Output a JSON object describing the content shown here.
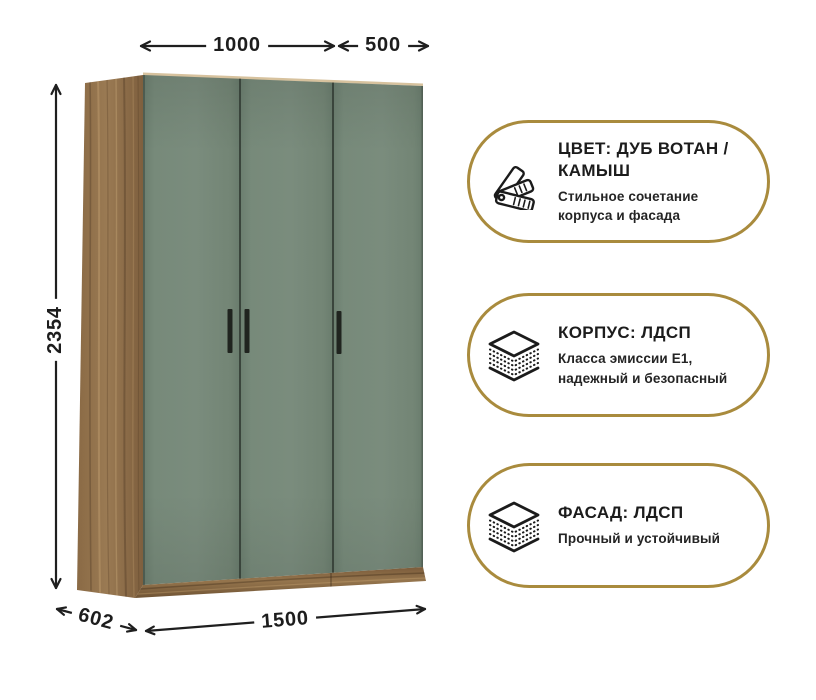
{
  "dimensions": {
    "door_pair_width": "1000",
    "door_single_width": "500",
    "height": "2354",
    "depth": "602",
    "total_width": "1500"
  },
  "badges": [
    {
      "icon": "color-swatches-icon",
      "title": "ЦВЕТ: ДУБ ВОТАН / КАМЫШ",
      "subtitle": "Стильное сочетание корпуса и фасада"
    },
    {
      "icon": "layered-board-icon",
      "title": "КОРПУС: ЛДСП",
      "subtitle": "Класса эмиссии Е1, надежный и безопасный"
    },
    {
      "icon": "layered-board-icon",
      "title": "ФАСАД: ЛДСП",
      "subtitle": "Прочный и устойчивый"
    }
  ],
  "colors": {
    "badge_border": "#a98b3d",
    "door_green": "#748776",
    "wood_brown": "#8c6d49",
    "dimension_text": "#1d1d1d"
  }
}
